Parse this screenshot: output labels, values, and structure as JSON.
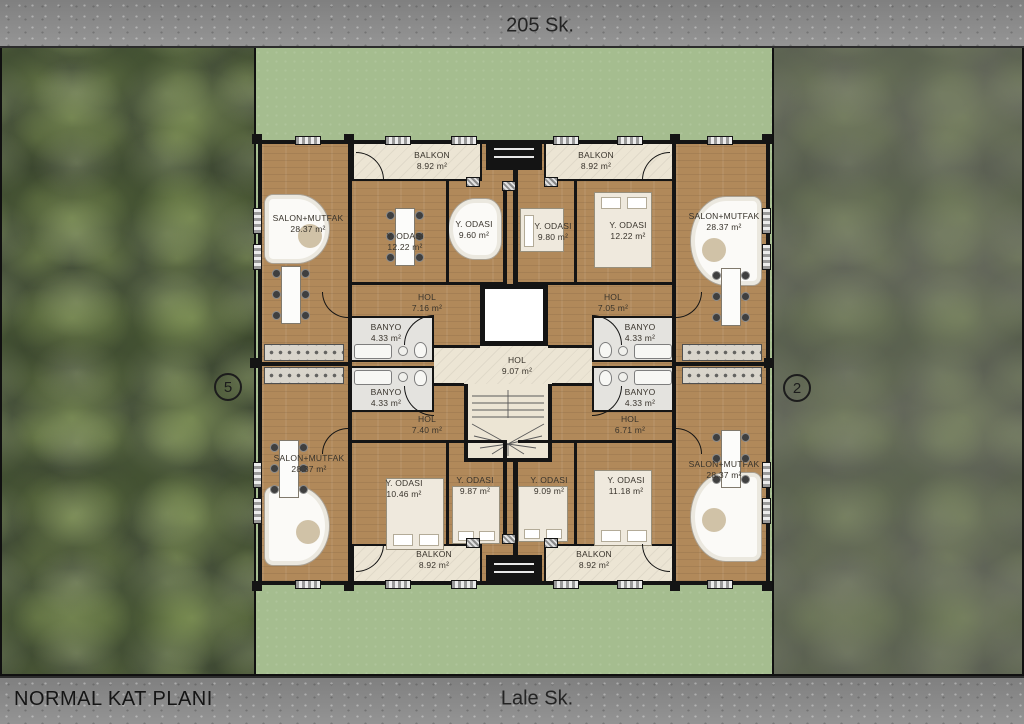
{
  "plan_title": "NORMAL KAT PLANI",
  "streets": {
    "top": "205 Sk.",
    "bottom": "Lale Sk."
  },
  "plot_markers": {
    "left": "5",
    "right": "2"
  },
  "colors": {
    "road": "#8e8e8e",
    "lawn": "#a5bd8f",
    "forest_left": "#49543c",
    "forest_right": "#575c4c",
    "floor_wood": "#b1895a",
    "wall": "#141414",
    "balcony": "#ece5d4",
    "bathroom": "#e4e3df",
    "label_text": "#38332b"
  },
  "rooms": [
    {
      "id": "balkon-top-left",
      "name": "BALKON",
      "area": "8.92 m²"
    },
    {
      "id": "salon-top-left",
      "name": "SALON+MUTFAK",
      "area": "28.37 m²"
    },
    {
      "id": "oda-top-left-mid",
      "name": "Y. ODASI",
      "area": "12.22 m²"
    },
    {
      "id": "oda-top-left-inner",
      "name": "Y. ODASI",
      "area": "9.60 m²"
    },
    {
      "id": "hol-top-left",
      "name": "HOL",
      "area": "7.16 m²"
    },
    {
      "id": "banyo-top-left",
      "name": "BANYO",
      "area": "4.33 m²"
    },
    {
      "id": "balkon-top-right",
      "name": "BALKON",
      "area": "8.92 m²"
    },
    {
      "id": "oda-top-right-inner",
      "name": "Y. ODASI",
      "area": "9.80 m²"
    },
    {
      "id": "oda-top-right-mid",
      "name": "Y. ODASI",
      "area": "12.22 m²"
    },
    {
      "id": "salon-top-right",
      "name": "SALON+MUTFAK",
      "area": "28.37 m²"
    },
    {
      "id": "hol-top-right",
      "name": "HOL",
      "area": "7.05 m²"
    },
    {
      "id": "banyo-top-right",
      "name": "BANYO",
      "area": "4.33 m²"
    },
    {
      "id": "hol-center",
      "name": "HOL",
      "area": "9.07 m²"
    },
    {
      "id": "banyo-bottom-left",
      "name": "BANYO",
      "area": "4.33 m²"
    },
    {
      "id": "hol-bottom-left",
      "name": "HOL",
      "area": "7.40 m²"
    },
    {
      "id": "salon-bottom-left",
      "name": "SALON+MUTFAK",
      "area": "28.37 m²"
    },
    {
      "id": "oda-bottom-left-mid",
      "name": "Y. ODASI",
      "area": "10.46 m²"
    },
    {
      "id": "oda-bottom-left-inner",
      "name": "Y. ODASI",
      "area": "9.87 m²"
    },
    {
      "id": "balkon-bottom-left",
      "name": "BALKON",
      "area": "8.92 m²"
    },
    {
      "id": "banyo-bottom-right",
      "name": "BANYO",
      "area": "4.33 m²"
    },
    {
      "id": "hol-bottom-right",
      "name": "HOL",
      "area": "6.71 m²"
    },
    {
      "id": "oda-bottom-right-inner",
      "name": "Y. ODASI",
      "area": "9.09 m²"
    },
    {
      "id": "oda-bottom-right-mid",
      "name": "Y. ODASI",
      "area": "11.18 m²"
    },
    {
      "id": "salon-bottom-right",
      "name": "SALON+MUTFAK",
      "area": "28.37 m²"
    },
    {
      "id": "balkon-bottom-right",
      "name": "BALKON",
      "area": "8.92 m²"
    }
  ]
}
